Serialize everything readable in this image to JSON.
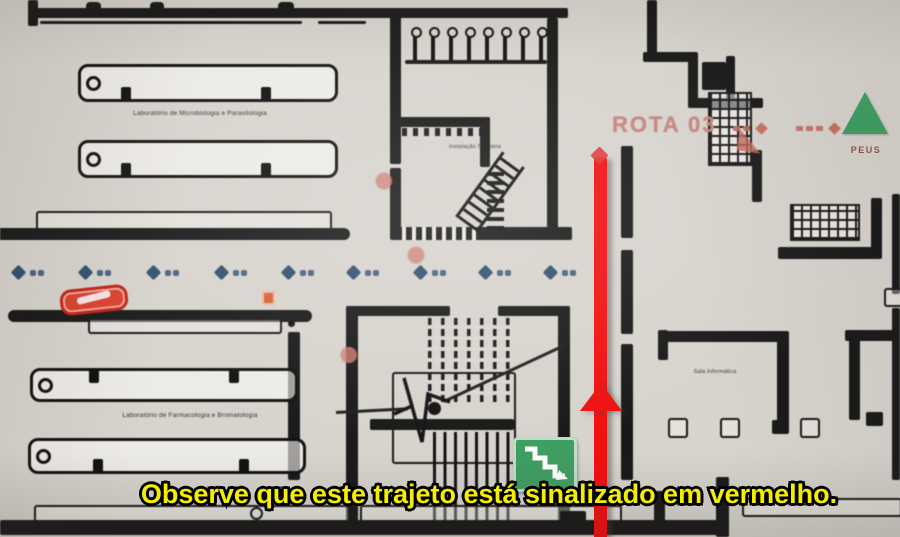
{
  "subtitle": {
    "text": "Observe que este trajeto está sinalizado em vermelho.",
    "color": "#f4ee00"
  },
  "map": {
    "route": {
      "label": "ROTA 03",
      "line_color": "#f01010",
      "label_color": "#c4837b"
    },
    "assembly_point": {
      "label": "PEUS",
      "triangle_color": "#3f9e62"
    },
    "exit_sign": {
      "meaning": "emergency-exit-stairs",
      "color": "#3f9e62"
    },
    "room_labels": {
      "lab_top": "Laboratório de Microbiologia e Parasitologia",
      "lab_bottom": "Laboratório de Farmacologia e Bromatologia",
      "sanitary": "Instalação Sanitária",
      "right_room": "Sala Informática"
    },
    "markers": {
      "diamond_row": {
        "color": "#32506e",
        "y": 266,
        "xs": [
          13,
          80,
          148,
          216,
          283,
          348,
          415,
          480,
          545
        ]
      },
      "salmon_dots": {
        "color": "#cf7d72",
        "points": [
          {
            "x": 376,
            "y": 173
          },
          {
            "x": 408,
            "y": 247
          },
          {
            "x": 341,
            "y": 347
          }
        ]
      },
      "dash_groups": {
        "color": "#c2685c",
        "groups": [
          {
            "x": 733,
            "y": 124,
            "dashes": 2
          },
          {
            "x": 796,
            "y": 124,
            "dashes": 3
          }
        ]
      },
      "extinguisher_color": "#d4623a",
      "hose_capsule_color": "#d9402e"
    },
    "fixtures": {
      "stall_count": 8
    }
  }
}
